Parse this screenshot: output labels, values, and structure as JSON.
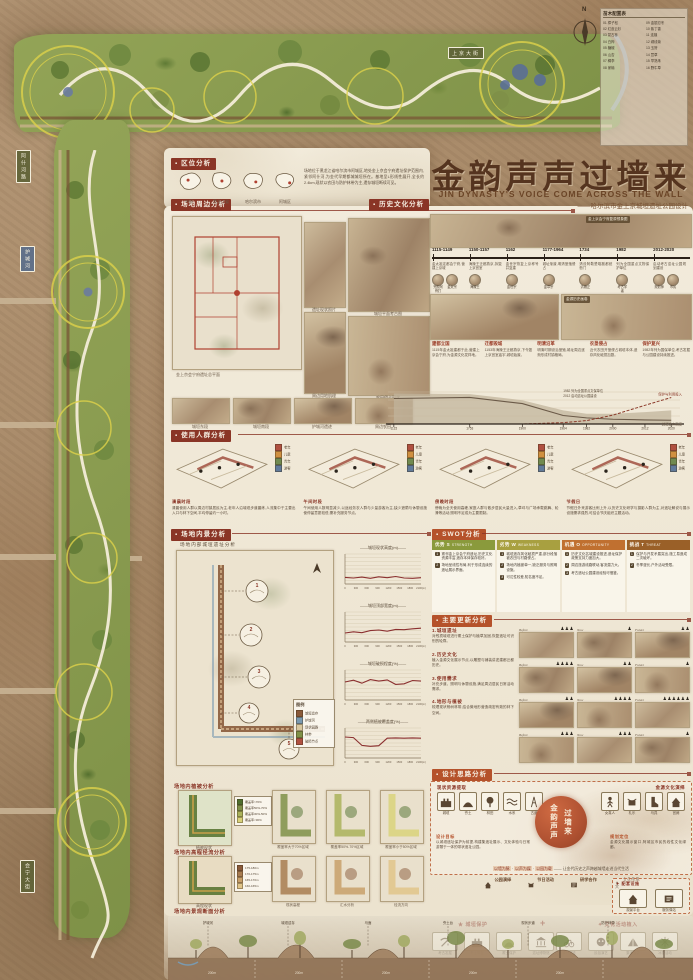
{
  "poster": {
    "title": "金韵声声过墙来",
    "title_en": "JIN DYNASTY'S VOICE COME ACROSS THE WALL",
    "subtitle": "——哈尔滨市金上京城垣遗址公园设计"
  },
  "compass": "N",
  "site_plan": {
    "labels": {
      "top_street": "上京大街",
      "bottom_street": "金源大街",
      "left_top_street": "阿什河路",
      "left_mid": "护城河",
      "left_bottom_street": "会宁大街",
      "wall_chip": "城垣遗址"
    },
    "plant_list_title": "苗木配置表",
    "plants": [
      "01 樟子松",
      "02 红皮云杉",
      "03 蒙古栎",
      "04 白桦",
      "05 糖槭",
      "06 山杏",
      "07 稠李",
      "08 家榆",
      "09 金银忍冬",
      "10 紫丁香",
      "11 连翘",
      "12 绣线菊",
      "13 玉簪",
      "14 萱草",
      "15 早熟禾",
      "16 野牛草"
    ]
  },
  "sections": {
    "location": {
      "header": "区位分析",
      "maps": [
        "中国",
        "黑龙江省",
        "哈尔滨市",
        "阿城区"
      ],
      "paragraph": "场地位于黑龙江省哈尔滨市阿城区,地处金上京会宁府遗址保护范围内,紧邻阿什河,为金代早期都城城垣所在。基地呈L形线性展开,全长约2.4km,现状以农田与防护林带为主,遗存城垣断续可见。"
    },
    "surrounding": {
      "header": "场地周边分析",
      "big_map_caption": "金上京会宁府遗址总平面",
      "figures": [
        "遗址现状照片",
        "城垣平面考古图",
        "周边用地肌理",
        "农田侵占现状"
      ],
      "photos": [
        "城垣东段",
        "城垣南段",
        "护城河遗迹",
        "周边农田"
      ]
    },
    "history": {
      "header": "历史文化分析",
      "collage_captions": [
        "金上京会宁府复原想象图",
        "金源历史画卷"
      ],
      "timeline": [
        {
          "dates": "1115-1149",
          "desc": "金太祖定都会宁府,营建上京城",
          "portraits": [
            "完颜阿骨打",
            "金太宗"
          ]
        },
        {
          "dates": "1150-1157",
          "desc": "海陵王迁都燕京,拆毁上京宫室",
          "portraits": [
            "海陵王"
          ]
        },
        {
          "dates": "1162",
          "desc": "金世宗恢复上京称号并复建",
          "portraits": [
            "金世宗"
          ]
        },
        {
          "dates": "1177-1964",
          "desc": "城址渐废,明清垦殖侵占",
          "portraits": [
            "金章宗"
          ]
        },
        {
          "dates": "1734",
          "desc": "清设阿勒楚喀副都统衙门",
          "portraits": [
            "清雍正"
          ]
        },
        {
          "dates": "1982",
          "desc": "列为全国重点文物保护单位",
          "portraits": [
            "考古学者"
          ]
        },
        {
          "dates": "2012-2020",
          "desc": "启动考古遗址公园规划建设",
          "portraits": [
            "规划师",
            "市民"
          ]
        }
      ],
      "events": [
        {
          "title": "建都立国",
          "desc": "1115年金太祖建都于此,营建上京会宁府,为金源文化发祥地。"
        },
        {
          "title": "迁都毁城",
          "desc": "1153年海陵王迁都燕京,下令毁上京宫室庙宇,城垣始废。"
        },
        {
          "title": "明清沿革",
          "desc": "明清时期设治垦殖,城址周边逐渐形成村镇格局。"
        },
        {
          "title": "农垦侵占",
          "desc": "近代农田开垦侵占城垣本体,遗存风化破损加剧。"
        },
        {
          "title": "保护复兴",
          "desc": "1982年列为国保单位,考古发掘与公园建设持续推进。"
        }
      ]
    },
    "users": {
      "header": "使用人群分析",
      "legend": [
        {
          "label": "老年",
          "color": "#b05040"
        },
        {
          "label": "儿童",
          "color": "#d09040"
        },
        {
          "label": "青年",
          "color": "#708a50"
        },
        {
          "label": "游客",
          "color": "#607a9a"
        }
      ],
      "groups": [
        {
          "time": "清晨时段",
          "desc": "清晨使用人群以周边村镇居民为主,老年人沿城垣步道晨练,人流集中于主要出入口与林下空间,平均停留约一小时。"
        },
        {
          "time": "午间时段",
          "desc": "午间使用人数明显减少,以途经务农人群与少量游客为主,缺少遮荫与休憩设施使停留意愿较低,需补充服务节点。"
        },
        {
          "time": "傍晚时段",
          "desc": "傍晚为全天使用高峰,家庭人群与散步居民大量进入,草坪与广场承载跳舞、轮滑等活动,照明不足成为主要限制。"
        },
        {
          "time": "节假日",
          "desc": "节假日外来游客比例上升,以历史文化研学与摄影人群为主,对遗址解说与展示设施需求强烈,可结合节庆组织主题活动。"
        }
      ]
    },
    "inner": {
      "header": "场地内景分析",
      "sub": "场地内部城垣遗址分析",
      "legend_title": "图例",
      "legend": [
        {
          "label": "城垣遗存",
          "color": "#8a5a3a"
        },
        {
          "label": "护城河",
          "color": "#7a9ab0"
        },
        {
          "label": "现状园路",
          "color": "#d8c8a0"
        },
        {
          "label": "林带",
          "color": "#7f9048"
        },
        {
          "label": "破损节点",
          "color": "#b05040"
        }
      ]
    },
    "swot": {
      "header": "SWOT分析",
      "columns": [
        {
          "title": "优势 S",
          "en": "STRENGTH",
          "color": "#8a9a3c",
          "items": [
            "紧邻金上京会宁府遗址,历史文化资源丰富,遗存本体保存较好。",
            "场地呈线性布局,利于形成连续的遗址展示界面。"
          ]
        },
        {
          "title": "劣势 W",
          "en": "WEAKNESS",
          "color": "#a8a040",
          "items": [
            "城垣遗存风化破损严重,部分段落被农田与村路侵占。",
            "场地内植被单一,缺乏服务与照明设施。",
            "可达性较差,知名度不足。"
          ]
        },
        {
          "title": "机遇 O",
          "en": "OPPORTUNITY",
          "color": "#c07030",
          "items": [
            "历史文化名城建设推进,遗址保护政策支持力度加大。",
            "周边旅游线路联动,客流潜力大。",
            "考古遗址公园建设经验可借鉴。"
          ]
        },
        {
          "title": "挑战 T",
          "en": "THREAT",
          "color": "#9a6028",
          "items": [
            "保护与开发矛盾突出,施工易造成二次破坏。",
            "冬季漫长,户外活动受限。"
          ]
        }
      ]
    },
    "renewal": {
      "header": "主要更新分析",
      "cols": [
        "Before",
        "Now",
        "Future"
      ],
      "items": [
        {
          "no": "1.",
          "title": "城垣遗址",
          "desc": "对残损城垣进行覆土保护与植草加固,恢复遗址可识别的轮廓。",
          "counts": [
            3,
            1,
            2
          ]
        },
        {
          "no": "2.",
          "title": "历史文化",
          "desc": "植入金源文化展示节点,以雕塑与铺装讲述建都迁都历史。",
          "counts": [
            4,
            2,
            1
          ]
        },
        {
          "no": "3.",
          "title": "使用需求",
          "desc": "补充步道、照明与休憩设施,满足周边居民日常活动需求。",
          "counts": [
            2,
            4,
            6
          ]
        },
        {
          "no": "4.",
          "title": "地形与植被",
          "desc": "梳理现状杨树林带,结合微地形营造疏密有致的林下空间。",
          "counts": [
            3,
            3,
            1
          ]
        }
      ]
    },
    "concept": {
      "header": "设计思路分析",
      "left_group_label": "现状资源提取",
      "right_group_label": "金源文化演绎",
      "left_icons": [
        {
          "type": "wall",
          "label": "城垣"
        },
        {
          "type": "mound",
          "label": "夯土"
        },
        {
          "type": "tree",
          "label": "林田"
        },
        {
          "type": "water",
          "label": "水系"
        },
        {
          "type": "road",
          "label": "古道"
        }
      ],
      "right_icons": [
        {
          "type": "person",
          "label": "女真人"
        },
        {
          "type": "drum",
          "label": "礼乐"
        },
        {
          "type": "boot",
          "label": "马具"
        },
        {
          "type": "tower",
          "label": "宫阙"
        }
      ],
      "seal_lines": [
        "金韵声声",
        "过墙来"
      ],
      "left_para": {
        "label": "设计目标",
        "text": "以城垣遗址保护为前提,构建集遗址展示、文化体验与日常游憩于一体的带状遗址公园。"
      },
      "right_para": {
        "label": "规划定位",
        "text": "金源文化展示窗口,阿城区市民的线性文化绿廊。"
      },
      "slogan_parts": [
        "以墙为脉",
        "以声为媒",
        "以园为载"
      ],
      "slogan_tail": "—— 让金代历史之声跨越城墙走进当代生活",
      "footer_items": [
        {
          "type": "tower",
          "label": "公园演绎"
        },
        {
          "type": "drum",
          "label": "节日活动"
        },
        {
          "type": "scroll",
          "label": "研学合作"
        },
        {
          "type": "person",
          "label": "文化传承"
        }
      ]
    },
    "strategy": {
      "left_label": "★ 城垣保护",
      "plus": "+",
      "right_label": "✦ 文化活动植入",
      "left_icons": [
        {
          "type": "pick",
          "label": "考古发掘"
        },
        {
          "type": "wall",
          "label": "夯土修复"
        },
        {
          "type": "mound",
          "label": "覆土保护"
        },
        {
          "type": "museum",
          "label": "遗址博物馆"
        }
      ],
      "right_icons": [
        {
          "type": "bike",
          "label": "骑行游览"
        },
        {
          "type": "mask",
          "label": "民俗演艺"
        },
        {
          "type": "tent",
          "label": "集市庙会"
        },
        {
          "type": "snow",
          "label": "冰雪活动"
        }
      ],
      "facility_label": "✦ 配套设施",
      "facility_icons": [
        {
          "type": "tower",
          "label": "观景平台"
        },
        {
          "type": "scroll",
          "label": "服务驿站"
        }
      ]
    },
    "veg": {
      "header": "场地内植被分析",
      "main_caption": "植被现状",
      "legend": [
        {
          "label": "覆盖率>70%",
          "color": "#4f6f2e"
        },
        {
          "label": "覆盖率50%-70%",
          "color": "#7f9048"
        },
        {
          "label": "覆盖率30%-50%",
          "color": "#aab25a"
        },
        {
          "label": "覆盖率<30%",
          "color": "#d9d27a"
        }
      ],
      "maps": [
        "覆盖率大于70%区域",
        "覆盖率50%-70%区域",
        "覆盖率小于50%区域"
      ]
    },
    "hydro": {
      "header": "场地内高程径流分析",
      "main_caption": "高程现状",
      "legend": [
        {
          "label": "175-180m",
          "color": "#8a5a3a"
        },
        {
          "label": "170-175m",
          "color": "#a87c50"
        },
        {
          "label": "165-170m",
          "color": "#c8a06a"
        },
        {
          "label": "160-165m",
          "color": "#e0c488"
        }
      ],
      "maps": [
        "现状高程",
        "汇水分析",
        "径流方向"
      ]
    },
    "section_drawing": {
      "header": "场地内景观断面分析",
      "labels": [
        "护城河",
        "城垣遗存",
        "马面",
        "夯土台",
        "现状步道",
        "防护林带"
      ],
      "dim": "200m"
    }
  },
  "chart_data": [
    {
      "id": "history_profile",
      "type": "area",
      "title": "城垣遗存与保护历程剖面",
      "x_years": [
        1115,
        1753,
        1900,
        1964,
        1982,
        2000,
        2012,
        2020
      ],
      "ylim": [
        0,
        10
      ],
      "series": [
        {
          "name": "历史风貌完整度",
          "values": [
            9,
            8.8,
            7,
            4,
            3,
            3,
            3.5,
            4
          ]
        },
        {
          "name": "城垣遗存高度",
          "values": [
            7.5,
            7.8,
            6,
            2.5,
            1.8,
            1.4,
            1.2,
            1.1
          ]
        },
        {
          "name": "保护与利用投入",
          "values": [
            0,
            0,
            0,
            0.4,
            1,
            2.6,
            5.5,
            7.8
          ]
        }
      ],
      "annotations": [
        "1982 列为全国重点文保单位",
        "2012 启动遗址公园建设"
      ]
    },
    {
      "id": "wall_height",
      "type": "line",
      "title": "——城垣现状高度(m)——",
      "ylim": [
        0,
        10
      ],
      "x_ticks": [
        "0",
        "300",
        "600",
        "900",
        "1200",
        "1500",
        "1800",
        "2100(m)"
      ],
      "values": [
        2.2,
        2.0,
        2.3,
        1.9,
        2.4,
        2.1,
        2.5,
        2.0,
        1.9,
        2.1
      ]
    },
    {
      "id": "wall_width",
      "type": "line",
      "title": "——城垣顶部宽度(m)——",
      "ylim": [
        0,
        10
      ],
      "x_ticks": [
        "0",
        "300",
        "600",
        "900",
        "1200",
        "1500",
        "1800",
        "2100(m)"
      ],
      "values": [
        3.0,
        3.4,
        3.1,
        3.8,
        4.0,
        3.6,
        4.2,
        4.1,
        4.4,
        4.6
      ]
    },
    {
      "id": "wall_damage",
      "type": "line",
      "title": "——城垣破损程度(%)——",
      "ylim": [
        0,
        10
      ],
      "x_ticks": [
        "0",
        "300",
        "600",
        "900",
        "1200",
        "1500",
        "1800",
        "2100(m)"
      ],
      "values": [
        6.0,
        6.6,
        5.6,
        6.8,
        6.3,
        6.7,
        5.2,
        5.4,
        6.5,
        6.3
      ]
    },
    {
      "id": "veg_cover",
      "type": "line",
      "title": "——两侧植被覆盖度(%)——",
      "ylim": [
        0,
        10
      ],
      "x_ticks": [
        "0",
        "300",
        "600",
        "900",
        "1200",
        "1500",
        "1800",
        "2100(m)"
      ],
      "values": [
        7.0,
        6.8,
        4.2,
        3.9,
        4.1,
        6.6,
        6.7,
        6.6,
        6.7,
        6.6
      ]
    }
  ]
}
